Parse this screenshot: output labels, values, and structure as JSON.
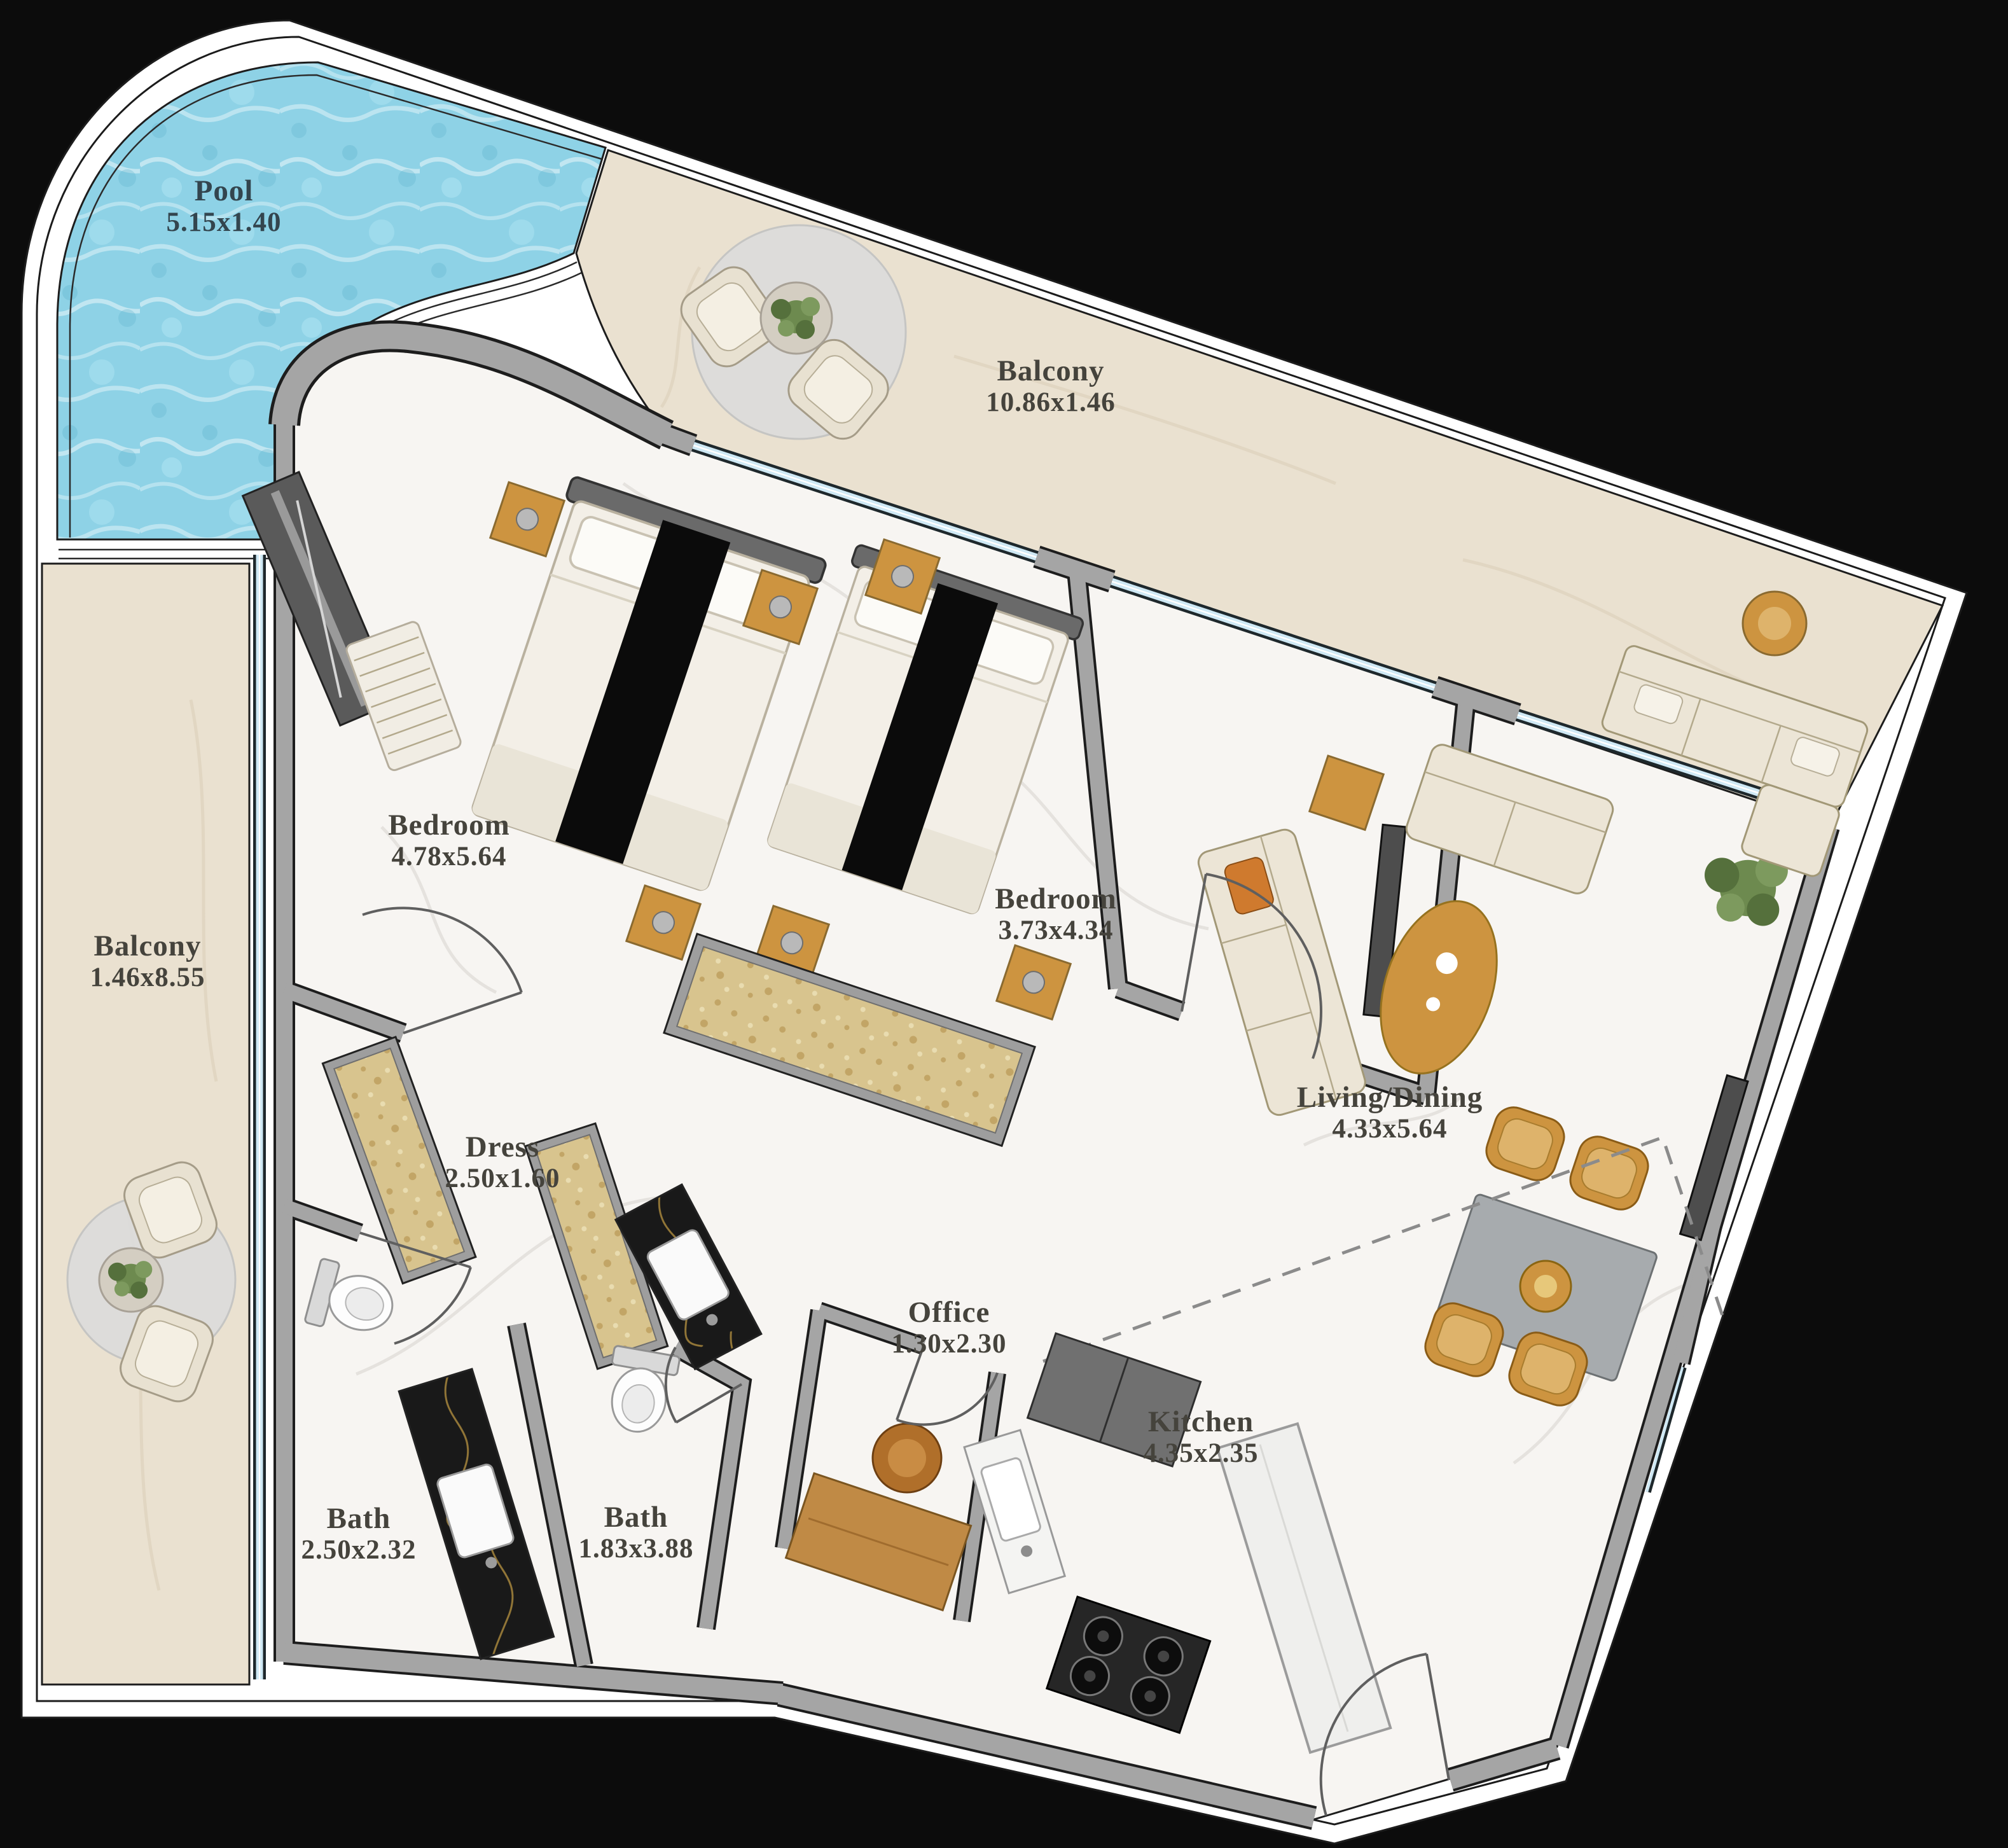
{
  "plan": {
    "rooms": {
      "pool": {
        "name": "Pool",
        "dims": "5.15x1.40"
      },
      "balcony_top": {
        "name": "Balcony",
        "dims": "10.86x1.46"
      },
      "balcony_left": {
        "name": "Balcony",
        "dims": "1.46x8.55"
      },
      "bedroom_1": {
        "name": "Bedroom",
        "dims": "4.78x5.64"
      },
      "bedroom_2": {
        "name": "Bedroom",
        "dims": "3.73x4.34"
      },
      "living_dining": {
        "name": "Living/Dining",
        "dims": "4.33x5.64"
      },
      "dress": {
        "name": "Dress",
        "dims": "2.50x1.60"
      },
      "office": {
        "name": "Office",
        "dims": "1.30x2.30"
      },
      "kitchen": {
        "name": "Kitchen",
        "dims": "4.35x2.35"
      },
      "bath_1": {
        "name": "Bath",
        "dims": "2.50x2.32"
      },
      "bath_2": {
        "name": "Bath",
        "dims": "1.83x3.88"
      }
    },
    "colors": {
      "background": "#0c0c0c",
      "outline_band": "#ffffff",
      "water": "#8ed2e6",
      "balcony_floor": "#eae1d0",
      "unit_floor": "#f7f5f2",
      "wall": "#a5a5a5",
      "window_glass": "#cfe9f5",
      "gold_accent": "#cd9440",
      "closet_gold": "#d8c48e",
      "label": "#45433c",
      "pool_label": "#33454e"
    }
  }
}
